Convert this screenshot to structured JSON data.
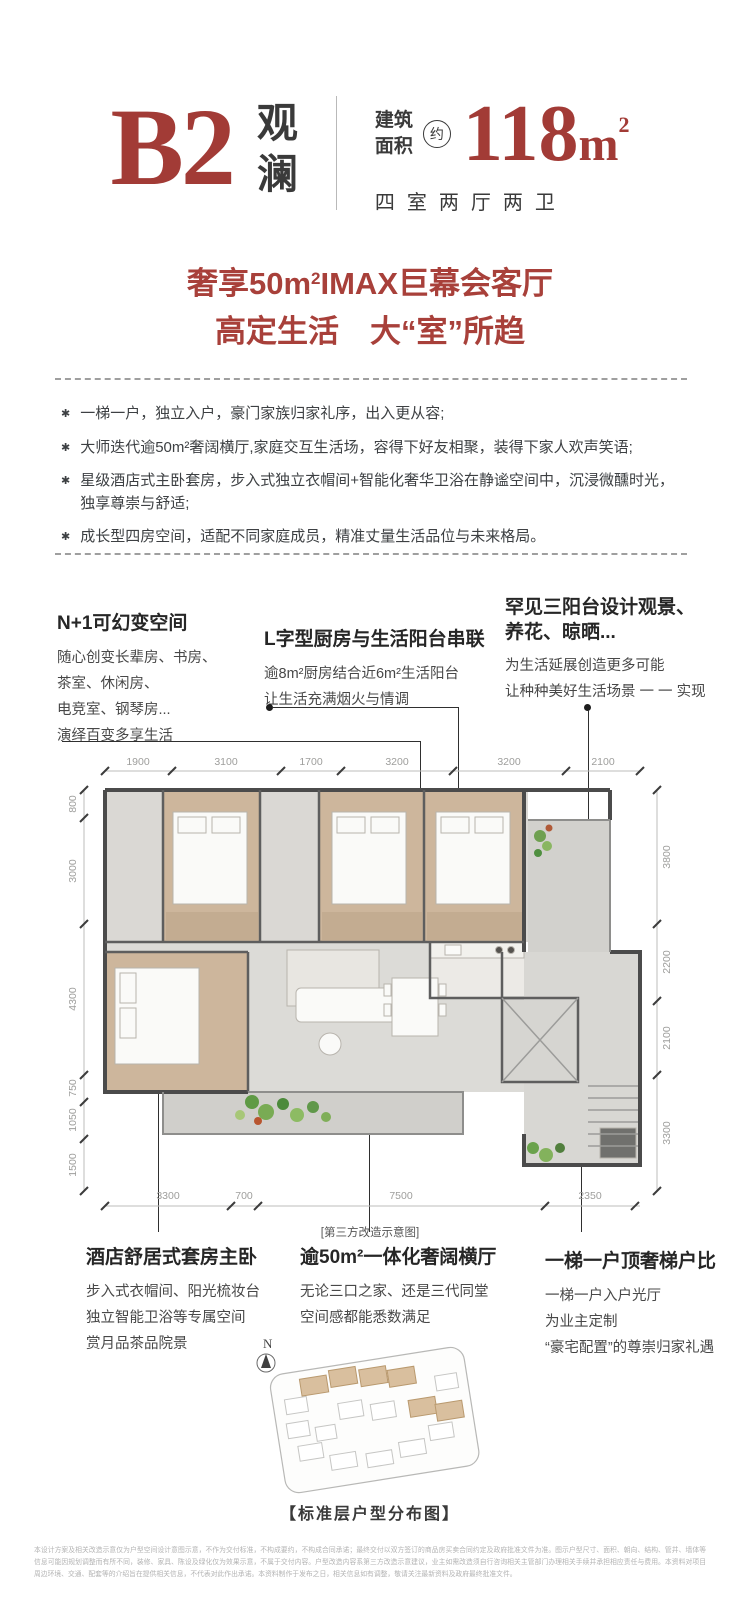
{
  "header": {
    "plan_code": "B2",
    "name_char1": "观",
    "name_char2": "澜",
    "area_label1": "建筑",
    "area_label2": "面积",
    "approx": "约",
    "area_value": "118",
    "area_unit": "m",
    "area_sup": "2",
    "layout_desc": "四室两厅两卫"
  },
  "headline": {
    "line1_pre": "奢享50m",
    "line1_sup": "2",
    "line1_post": "IMAX巨幕会客厅",
    "line2": "高定生活　大“室”所趋"
  },
  "features": {
    "marker": "✱",
    "items": [
      "一梯一户，独立入户，豪门家族归家礼序，出入更从容;",
      "大师迭代逾50m²奢阔横厅,家庭交互生活场，容得下好友相聚，装得下家人欢声笑语;",
      "星级酒店式主卧套房，步入式独立衣帽间+智能化奢华卫浴在静谧空间中，沉浸微醺时光，独享尊崇与舒适;",
      "成长型四房空间，适配不同家庭成员，精准丈量生活品位与未来格局。"
    ]
  },
  "callouts_top": [
    {
      "title": "N+1可幻变空间",
      "lines": [
        "随心创变长辈房、书房、",
        "茶室、休闲房、",
        "电竞室、钢琴房...",
        "演绎百变多享生活"
      ]
    },
    {
      "title": "L字型厨房与生活阳台串联",
      "lines": [
        "逾8m²厨房结合近6m²生活阳台",
        "让生活充满烟火与情调"
      ]
    },
    {
      "title1": "罕见三阳台设计观景、",
      "title2": "养花、晾晒...",
      "lines": [
        "为生活延展创造更多可能",
        "让种种美好生活场景 一 一 实现"
      ]
    }
  ],
  "callouts_bottom": [
    {
      "title": "酒店舒居式套房主卧",
      "lines": [
        "步入式衣帽间、阳光梳妆台",
        "独立智能卫浴等专属空间",
        "赏月品茶品院景"
      ]
    },
    {
      "title": "逾50m²一体化奢阔横厅",
      "lines": [
        "无论三口之家、还是三代同堂",
        "空间感都能悉数满足"
      ]
    },
    {
      "title": "一梯一户顶奢梯户比",
      "lines": [
        "一梯一户入户光厅",
        "为业主定制",
        "“豪宅配置”的尊崇归家礼遇"
      ]
    }
  ],
  "floorplan": {
    "caption": "[第三方改造示意图]",
    "dims_top": [
      "1900",
      "3100",
      "1700",
      "3200",
      "3200",
      "2100"
    ],
    "dims_left": [
      "800",
      "3000",
      "4300",
      "750",
      "1050",
      "1500"
    ],
    "dims_right": [
      "3800",
      "2200",
      "2100",
      "3300"
    ],
    "dims_bottom": [
      "3300",
      "700",
      "7500",
      "2350"
    ]
  },
  "siteplan": {
    "north": "N",
    "caption": "【标准层户型分布图】"
  },
  "disclaimer": {
    "text": "本设计方案及相关改造示意仅为户型空间设计意图示意，不作为交付标准，不构成要约，不构成合同承诺；最终交付以双方签订的商品房买卖合同约定及政府批准文件为准。图示户型尺寸、面积、朝向、结构、管井、墙体等信息可能因规划调整而有所不同，装修、家具、陈设及绿化仅为效果示意，不属于交付内容。户型改造内容系第三方改造示意建议，业主如需改造须自行咨询相关主管部门办理相关手续并承担相应责任与费用。本资料对项目周边环境、交通、配套等的介绍旨在提供相关信息，不代表对此作出承诺。本资料制作于发布之日，相关信息如有调整，敬请关注最新资料及政府最终批准文件。"
  }
}
